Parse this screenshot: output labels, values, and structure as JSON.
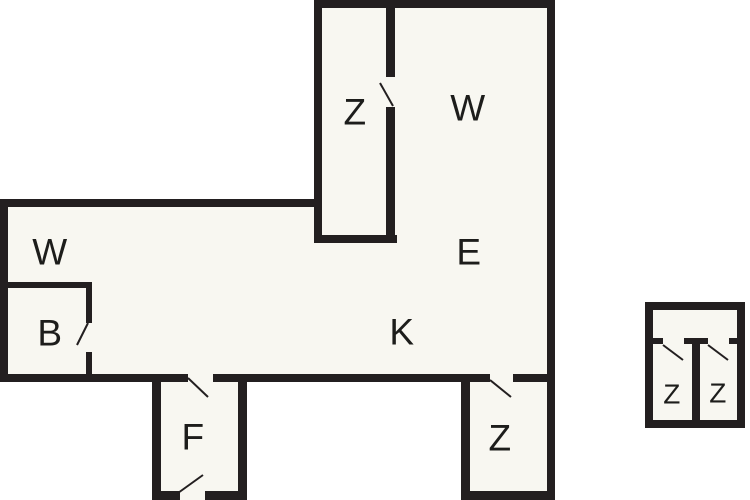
{
  "canvas": {
    "width": 750,
    "height": 500,
    "background": "#ffffff"
  },
  "colors": {
    "wall": "#231f20",
    "floor": "#f8f7f1",
    "label": "#1d1d1b",
    "outside": "#ffffff"
  },
  "floorplan": {
    "floors": [
      {
        "x": 314,
        "y": 0,
        "w": 241,
        "h": 382
      },
      {
        "x": 0,
        "y": 199,
        "w": 555,
        "h": 183
      },
      {
        "x": 152,
        "y": 374,
        "w": 95,
        "h": 126
      },
      {
        "x": 461,
        "y": 374,
        "w": 94,
        "h": 126
      },
      {
        "x": 645,
        "y": 302,
        "w": 100,
        "h": 126
      }
    ],
    "walls": [
      {
        "x": 314,
        "y": 0,
        "w": 241,
        "h": 8
      },
      {
        "x": 314,
        "y": 0,
        "w": 8,
        "h": 243
      },
      {
        "x": 386,
        "y": 8,
        "w": 9,
        "h": 69
      },
      {
        "x": 386,
        "y": 107,
        "w": 9,
        "h": 136
      },
      {
        "x": 314,
        "y": 235,
        "w": 83,
        "h": 8
      },
      {
        "x": 547,
        "y": 0,
        "w": 8,
        "h": 500
      },
      {
        "x": 0,
        "y": 199,
        "w": 318,
        "h": 8
      },
      {
        "x": 0,
        "y": 199,
        "w": 8,
        "h": 183
      },
      {
        "x": 0,
        "y": 374,
        "w": 188,
        "h": 8
      },
      {
        "x": 213,
        "y": 374,
        "w": 277,
        "h": 8
      },
      {
        "x": 513,
        "y": 374,
        "w": 42,
        "h": 8
      },
      {
        "x": 0,
        "y": 282,
        "w": 92,
        "h": 6
      },
      {
        "x": 86,
        "y": 282,
        "w": 6,
        "h": 41
      },
      {
        "x": 86,
        "y": 352,
        "w": 6,
        "h": 30
      },
      {
        "x": 152,
        "y": 374,
        "w": 9,
        "h": 126
      },
      {
        "x": 238,
        "y": 374,
        "w": 9,
        "h": 126
      },
      {
        "x": 152,
        "y": 491,
        "w": 28,
        "h": 9
      },
      {
        "x": 205,
        "y": 491,
        "w": 42,
        "h": 9
      },
      {
        "x": 461,
        "y": 374,
        "w": 9,
        "h": 126
      },
      {
        "x": 461,
        "y": 491,
        "w": 94,
        "h": 9
      },
      {
        "x": 645,
        "y": 302,
        "w": 100,
        "h": 8
      },
      {
        "x": 645,
        "y": 302,
        "w": 8,
        "h": 126
      },
      {
        "x": 737,
        "y": 302,
        "w": 8,
        "h": 126
      },
      {
        "x": 645,
        "y": 420,
        "w": 100,
        "h": 8
      },
      {
        "x": 653,
        "y": 338,
        "w": 10,
        "h": 6
      },
      {
        "x": 684,
        "y": 338,
        "w": 24,
        "h": 6
      },
      {
        "x": 729,
        "y": 338,
        "w": 8,
        "h": 6
      },
      {
        "x": 692,
        "y": 338,
        "w": 8,
        "h": 90
      }
    ],
    "doors": [
      {
        "x1": 380,
        "y1": 83,
        "x2": 393,
        "y2": 106
      },
      {
        "x1": 77,
        "y1": 345,
        "x2": 88,
        "y2": 323
      },
      {
        "x1": 188,
        "y1": 378,
        "x2": 208,
        "y2": 397
      },
      {
        "x1": 178,
        "y1": 493,
        "x2": 203,
        "y2": 475
      },
      {
        "x1": 490,
        "y1": 380,
        "x2": 511,
        "y2": 397
      },
      {
        "x1": 663,
        "y1": 345,
        "x2": 683,
        "y2": 360
      },
      {
        "x1": 708,
        "y1": 345,
        "x2": 728,
        "y2": 360
      }
    ],
    "rooms": [
      {
        "label": "Z",
        "x": 355,
        "y": 112,
        "size": 37
      },
      {
        "label": "W",
        "x": 468,
        "y": 108,
        "size": 37
      },
      {
        "label": "W",
        "x": 50,
        "y": 252,
        "size": 37
      },
      {
        "label": "E",
        "x": 469,
        "y": 252,
        "size": 37
      },
      {
        "label": "B",
        "x": 50,
        "y": 333,
        "size": 37
      },
      {
        "label": "K",
        "x": 402,
        "y": 332,
        "size": 37
      },
      {
        "label": "F",
        "x": 193,
        "y": 437,
        "size": 37
      },
      {
        "label": "Z",
        "x": 500,
        "y": 438,
        "size": 37
      },
      {
        "label": "Z",
        "x": 672,
        "y": 394,
        "size": 28
      },
      {
        "label": "Z",
        "x": 718,
        "y": 393,
        "size": 28
      }
    ]
  }
}
